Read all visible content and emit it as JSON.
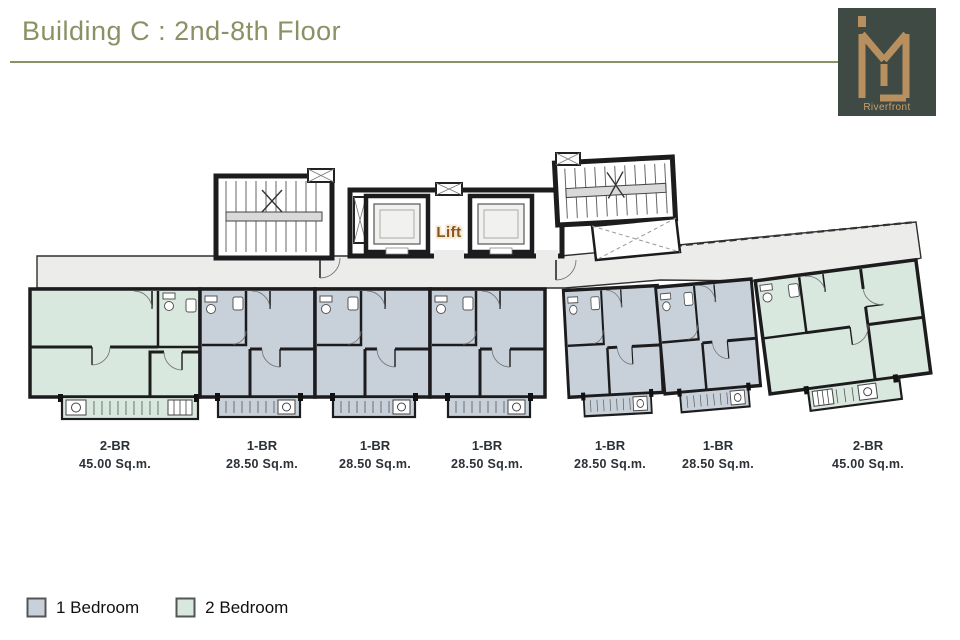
{
  "header": {
    "title": "Building C : 2nd-8th Floor",
    "accent_color": "#8a9164"
  },
  "logo": {
    "brand": "Riverfront",
    "bg_color": "#3e4a43",
    "monogram_color": "#b8905f"
  },
  "plan": {
    "lift_label": "Lift",
    "colors": {
      "one_bedroom": "#c8d1d9",
      "two_bedroom": "#d9e8de",
      "corridor": "#ececeb",
      "wall": "#1c1c1e"
    }
  },
  "units": [
    {
      "type": "2-BR",
      "area": "45.00 Sq.m."
    },
    {
      "type": "1-BR",
      "area": "28.50 Sq.m."
    },
    {
      "type": "1-BR",
      "area": "28.50 Sq.m."
    },
    {
      "type": "1-BR",
      "area": "28.50 Sq.m."
    },
    {
      "type": "1-BR",
      "area": "28.50 Sq.m."
    },
    {
      "type": "1-BR",
      "area": "28.50 Sq.m."
    },
    {
      "type": "2-BR",
      "area": "45.00 Sq.m."
    }
  ],
  "legend": {
    "items": [
      {
        "label": "1 Bedroom",
        "color": "#c8d1d9"
      },
      {
        "label": "2 Bedroom",
        "color": "#d9e8de"
      }
    ]
  }
}
